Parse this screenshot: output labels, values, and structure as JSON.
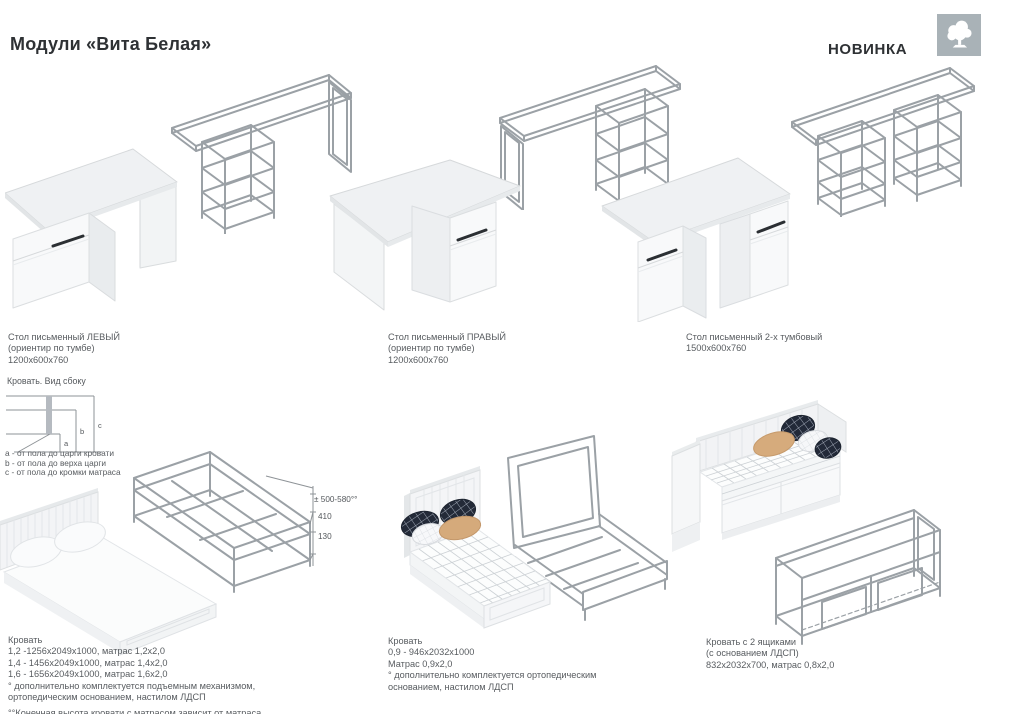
{
  "header": {
    "title": "Модули «Вита Белая»",
    "badge": "НОВИНКА"
  },
  "logo": {
    "icon": "tree-icon",
    "bg_color": "#a9b2b7"
  },
  "colors": {
    "wireframe": "#9ba1a6",
    "text": "#585c60",
    "handle": "#2b2f33",
    "pillow_tan": "#d5aa7b",
    "pillow_plaid": "#232a38"
  },
  "desks": {
    "left": {
      "name": "Стол письменный ЛЕВЫЙ",
      "note": "(ориентир по тумбе)",
      "size": "1200x600x760"
    },
    "right": {
      "name": "Стол письменный ПРАВЫЙ",
      "note": "(ориентир по тумбе)",
      "size": "1200x600x760"
    },
    "double": {
      "name": "Стол письменный 2-х тумбовый",
      "size": "1500x600x760"
    }
  },
  "side_view": {
    "title": "Кровать. Вид сбоку",
    "label_a": "a",
    "label_b": "b",
    "label_c": "c",
    "legend_a": "a - от пола до царги кровати",
    "legend_b": "b - от пола до верха царги",
    "legend_c": "c - от пола до кромки матраса"
  },
  "dims": {
    "range": "± 500-580°°",
    "mid": "410",
    "low": "130"
  },
  "bed_double": {
    "title": "Кровать",
    "l1": "1,2 -1256x2049x1000, матрас 1,2x2,0",
    "l2": "1,4 - 1456x2049x1000, матрас 1,4x2,0",
    "l3": "1,6 - 1656x2049x1000, матрас 1,6x2,0",
    "note1": "° дополнительно комплектуется подъемным механизмом,",
    "note2": "ортопедическим основанием, настилом ЛДСП",
    "footnote": "°°Конечная высота кровати с матрасом зависит от матраса"
  },
  "bed_single": {
    "title": "Кровать",
    "l1": "0,9 - 946x2032x1000",
    "l2": "Матрас 0,9x2,0",
    "note1": "° дополнительно комплектуется ортопедическим",
    "note2": "основанием, настилом ЛДСП"
  },
  "bed_drawers": {
    "title": "Кровать с 2 ящиками",
    "l1": "(с основанием ЛДСП)",
    "l2": "832x2032x700, матрас 0,8x2,0"
  }
}
